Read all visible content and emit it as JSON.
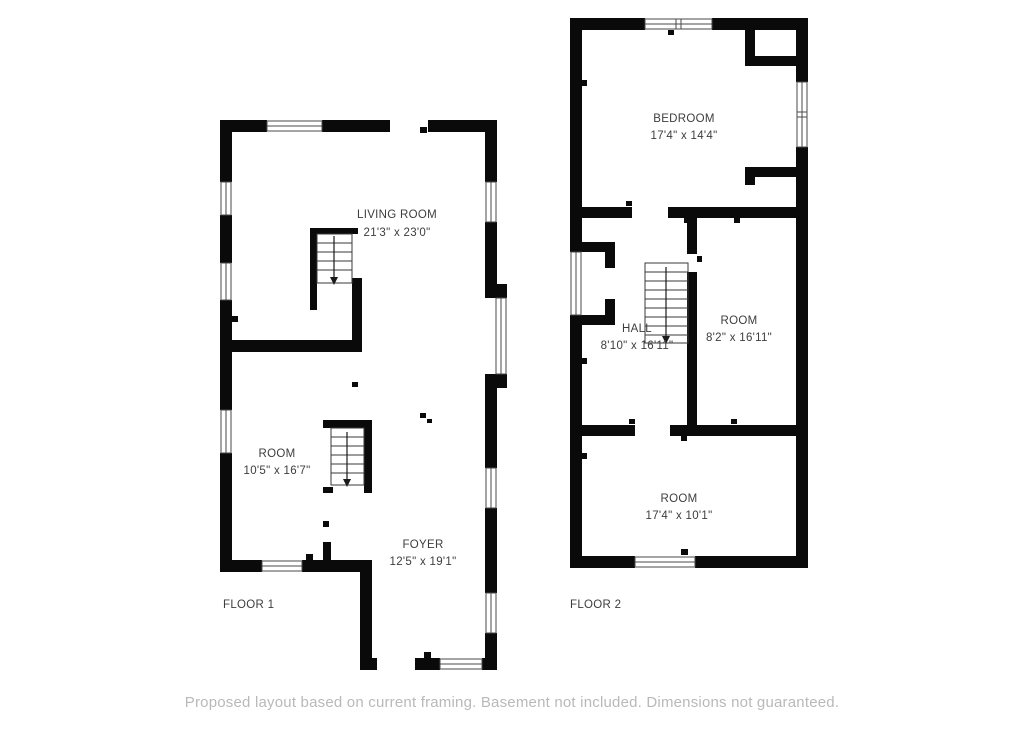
{
  "title": "Two floor house floor plan",
  "colors": {
    "wall": "#0a0a0a",
    "text": "#3d3d3d",
    "muted": "#b9b9b9",
    "background": "#ffffff"
  },
  "floor1": {
    "label": "FLOOR 1",
    "rooms": [
      {
        "name": "LIVING ROOM",
        "dims": "21'3\" x 23'0\""
      },
      {
        "name": "ROOM",
        "dims": "10'5\" x 16'7\""
      },
      {
        "name": "FOYER",
        "dims": "12'5\" x 19'1\""
      }
    ]
  },
  "floor2": {
    "label": "FLOOR 2",
    "rooms": [
      {
        "name": "BEDROOM",
        "dims": "17'4\" x 14'4\""
      },
      {
        "name": "HALL",
        "dims": "8'10\" x 16'11\""
      },
      {
        "name": "ROOM",
        "dims": "8'2\" x 16'11\""
      },
      {
        "name": "ROOM",
        "dims": "17'4\" x 10'1\""
      }
    ]
  },
  "footer": {
    "disclaimer": "Proposed layout based on current framing. Basement not included. Dimensions not guaranteed."
  }
}
